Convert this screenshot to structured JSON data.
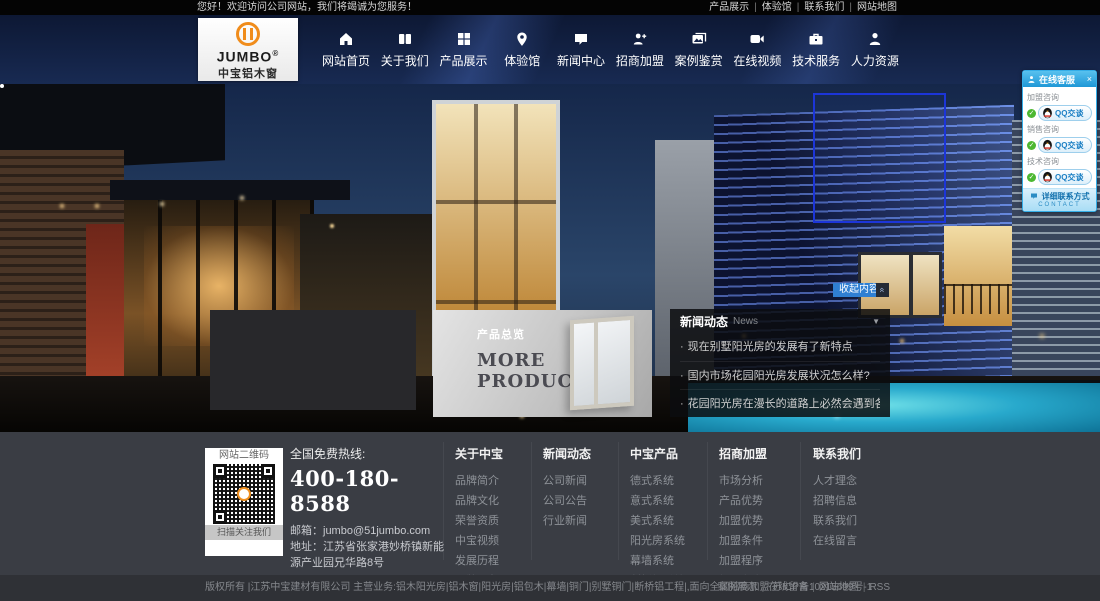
{
  "topbar": {
    "welcome": "您好！欢迎访问公司网站，我们将竭诚为您服务！",
    "divider": "|",
    "links": [
      "产品展示",
      "体验馆",
      "联系我们",
      "网站地图"
    ]
  },
  "logo": {
    "brand": "JUMBO",
    "reg": "®",
    "subtitle": "中宝铝木窗"
  },
  "nav": {
    "items": [
      {
        "label": "网站首页",
        "icon": "home-icon"
      },
      {
        "label": "关于我们",
        "icon": "book-icon"
      },
      {
        "label": "产品展示",
        "icon": "grid-icon"
      },
      {
        "label": "体验馆",
        "icon": "map-pin-icon"
      },
      {
        "label": "新闻中心",
        "icon": "chat-icon"
      },
      {
        "label": "招商加盟",
        "icon": "user-plus-icon"
      },
      {
        "label": "案例鉴赏",
        "icon": "gallery-icon"
      },
      {
        "label": "在线视频",
        "icon": "video-icon"
      },
      {
        "label": "技术服务",
        "icon": "briefcase-icon"
      },
      {
        "label": "人力资源",
        "icon": "user-icon"
      }
    ]
  },
  "hero": {
    "products": {
      "title": "产品总览",
      "more_line1": "MORE",
      "more_line2": "PRODUCTS"
    },
    "collapse": {
      "label": "收起内容",
      "top_icon": "«"
    },
    "news": {
      "title": "新闻动态",
      "subtitle": "News",
      "arrow": "▼",
      "bullet": "·",
      "items": [
        "现在别墅阳光房的发展有了新特点",
        "国内市场花园阳光房发展状况怎么样?",
        "花园阳光房在漫长的道路上必然会遇到各种挑战"
      ]
    }
  },
  "service_panel": {
    "title": "在线客服",
    "close": "×",
    "check": "✓",
    "qq_label": "QQ交谈",
    "groups": [
      {
        "label": "加盟咨询"
      },
      {
        "label": "销售咨询"
      },
      {
        "label": "技术咨询"
      }
    ],
    "footer": "详细联系方式",
    "footer_sub": "CONTACT",
    "accent_color": "#27a5e5"
  },
  "footer": {
    "qr": {
      "title": "网站二维码",
      "caption": "扫描关注我们"
    },
    "contact": {
      "hotline_label": "全国免费热线:",
      "hotline": "400-180-8588",
      "email_label": "邮箱：",
      "email": "jumbo@51jumbo.com",
      "address_label": "地址：",
      "address": "江苏省张家港妙桥镇新能源产业园兄华路8号",
      "sub_label": "中宝旗下公司：",
      "sub_company": "天一防盗铜门"
    },
    "columns": [
      {
        "title": "关于中宝",
        "links": [
          "品牌简介",
          "品牌文化",
          "荣誉资质",
          "中宝视频",
          "发展历程",
          "品牌形象"
        ]
      },
      {
        "title": "新闻动态",
        "links": [
          "公司新闻",
          "公司公告",
          "行业新闻"
        ]
      },
      {
        "title": "中宝产品",
        "links": [
          "德式系统",
          "意式系统",
          "美式系统",
          "阳光房系统",
          "幕墙系统",
          "断桥铝系统"
        ]
      },
      {
        "title": "招商加盟",
        "links": [
          "市场分析",
          "产品优势",
          "加盟优势",
          "加盟条件",
          "加盟程序",
          "加盟留言",
          "申请表下载"
        ]
      },
      {
        "title": "联系我们",
        "links": [
          "人才理念",
          "招聘信息",
          "联系我们",
          "在线留言"
        ]
      }
    ]
  },
  "bottombar": {
    "copyright": "版权所有 |江苏中宝建材有限公司 主营业务:铝木阳光房|铝木窗|阳光房|铝包木|幕墙|铜门|别墅铜门|断桥铝工程|,面向全国招商加盟 苏ICP备10215699号-1",
    "divider": "|",
    "links": [
      "案例展示",
      "在线留言",
      "网站地图",
      "RSS"
    ]
  }
}
